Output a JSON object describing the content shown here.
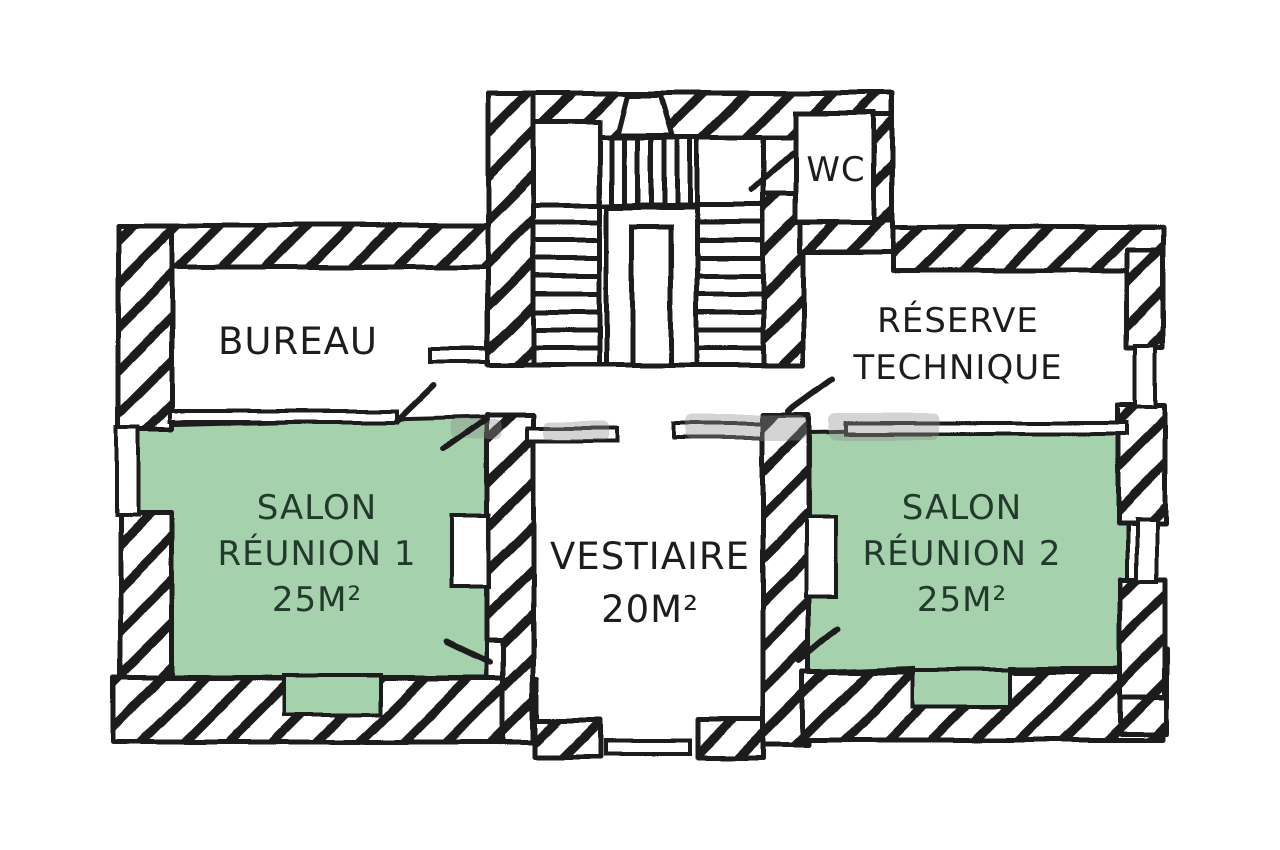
{
  "rooms": {
    "bureau": {
      "label": "BUREAU"
    },
    "wc": {
      "label": "WC"
    },
    "reserve_technique": {
      "line1": "RÉSERVE",
      "line2": "TECHNIQUE"
    },
    "salon_reunion_1": {
      "line1": "SALON",
      "line2": "RÉUNION 1",
      "area": "25M²"
    },
    "vestiaire": {
      "label": "VESTIAIRE",
      "area": "20M²"
    },
    "salon_reunion_2": {
      "line1": "SALON",
      "line2": "RÉUNION 2",
      "area": "25M²"
    }
  },
  "colors": {
    "background": "#ffffff",
    "line": "#1d1d1b",
    "highlight_green": "#a5d1ac",
    "room_label_dark": "#223a2c",
    "watermark_gray": "#8f8f8f"
  }
}
